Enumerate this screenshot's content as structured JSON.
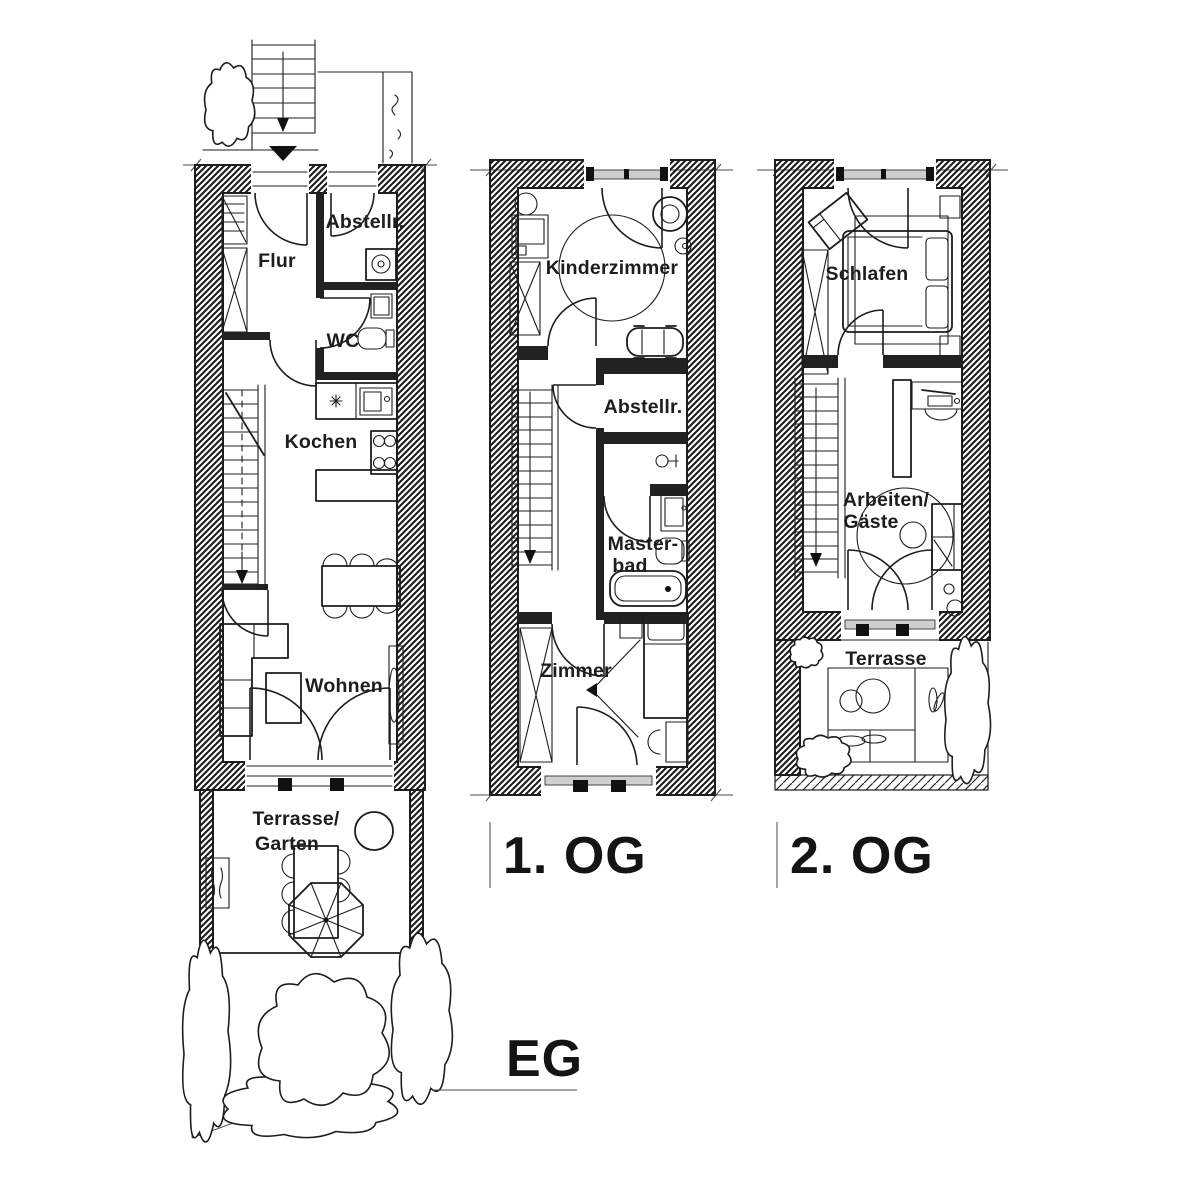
{
  "colors": {
    "ink": "#1d1d1d",
    "paper": "#ffffff",
    "glass": "#cfcfcf"
  },
  "floors": {
    "eg": {
      "label": "EG",
      "rooms": {
        "flur": "Flur",
        "abstellraum": "Abstellr.",
        "wc": "WC",
        "kochen": "Kochen",
        "wohnen": "Wohnen",
        "terrasse_garten": [
          "Terrasse/",
          "Garten"
        ]
      }
    },
    "og1": {
      "label": "1. OG",
      "rooms": {
        "kinderzimmer": "Kinderzimmer",
        "abstellraum": "Abstellr.",
        "masterbad": [
          "Master-",
          "bad"
        ],
        "zimmer": "Zimmer"
      }
    },
    "og2": {
      "label": "2. OG",
      "rooms": {
        "schlafen": "Schlafen",
        "arbeiten_gaeste": [
          "Arbeiten/",
          "Gäste"
        ],
        "terrasse": "Terrasse"
      }
    }
  }
}
